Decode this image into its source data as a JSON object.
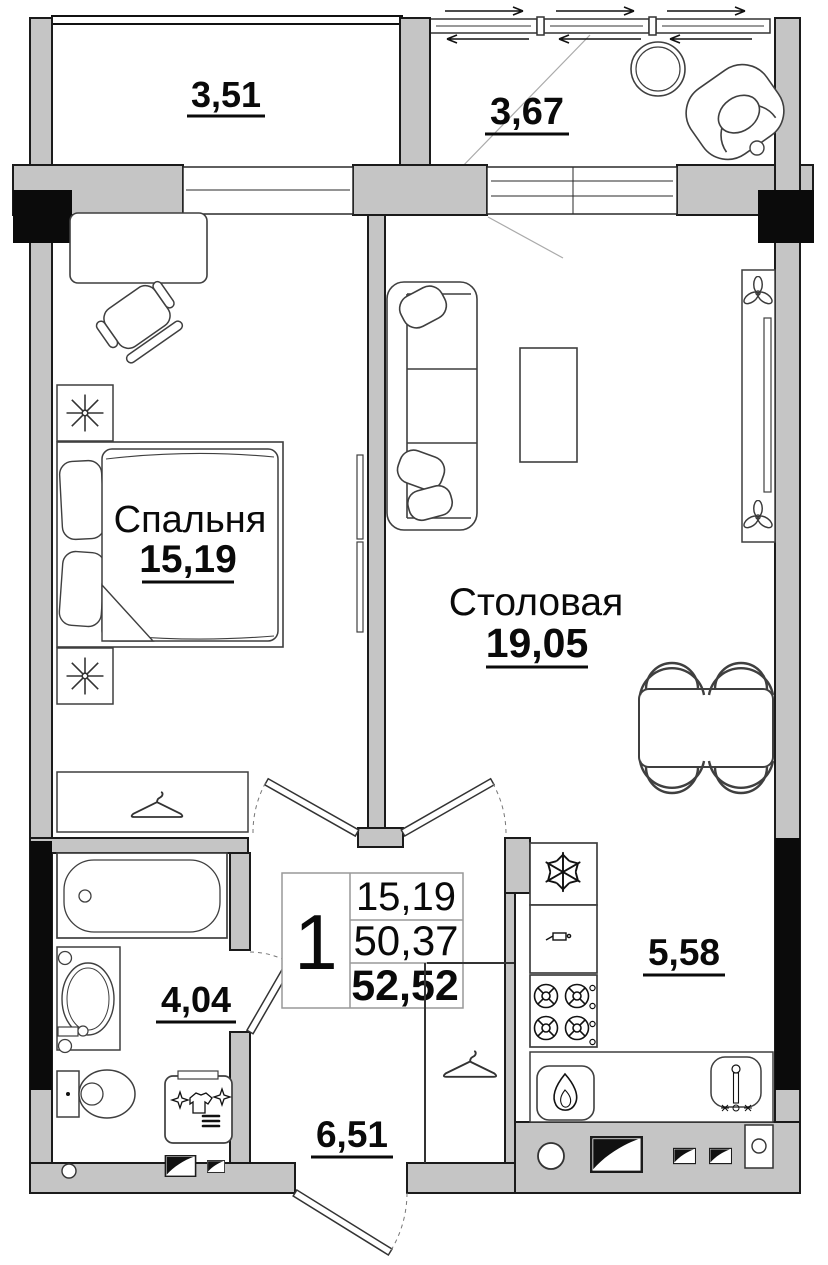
{
  "document": {
    "type": "floor-plan",
    "language": "ru"
  },
  "rooms": [
    {
      "key": "balcony-left",
      "label": "",
      "area": "3,51"
    },
    {
      "key": "balcony-right",
      "label": "",
      "area": "3,67"
    },
    {
      "key": "bedroom",
      "label": "Спальня",
      "area": "15,19"
    },
    {
      "key": "dining-room",
      "label": "Столовая",
      "area": "19,05"
    },
    {
      "key": "bathroom",
      "label": "",
      "area": "4,04"
    },
    {
      "key": "kitchen",
      "label": "",
      "area": "5,58"
    },
    {
      "key": "hallway",
      "label": "",
      "area": "6,51"
    }
  ],
  "summary_table": {
    "rooms_count": "1",
    "living_area": "15,19",
    "area_without_balconies": "50,37",
    "total_area": "52,52"
  },
  "icons": {
    "hanger-icon": "clothes hanger (wardrobe)",
    "snowflake-icon": "fridge",
    "flame-icon": "gas water heater",
    "burner-icon": "gas stove burner",
    "fan-icon": "8-spoke star (bedside unit)",
    "plant-icon": "flower / plant",
    "vent-icon": "ventilation shaft",
    "tap-icon": "faucet",
    "sparkle-icon": "washing machine",
    "arrow-icon": "sliding window direction"
  },
  "colors": {
    "wall_fill": "#c5c5c5",
    "wall_outline": "#1b1b1b",
    "column_fill": "#0b0b0b",
    "furniture_stroke": "#3f3f3f",
    "label_color": "#0a0a0a",
    "table_grid": "#999999"
  }
}
